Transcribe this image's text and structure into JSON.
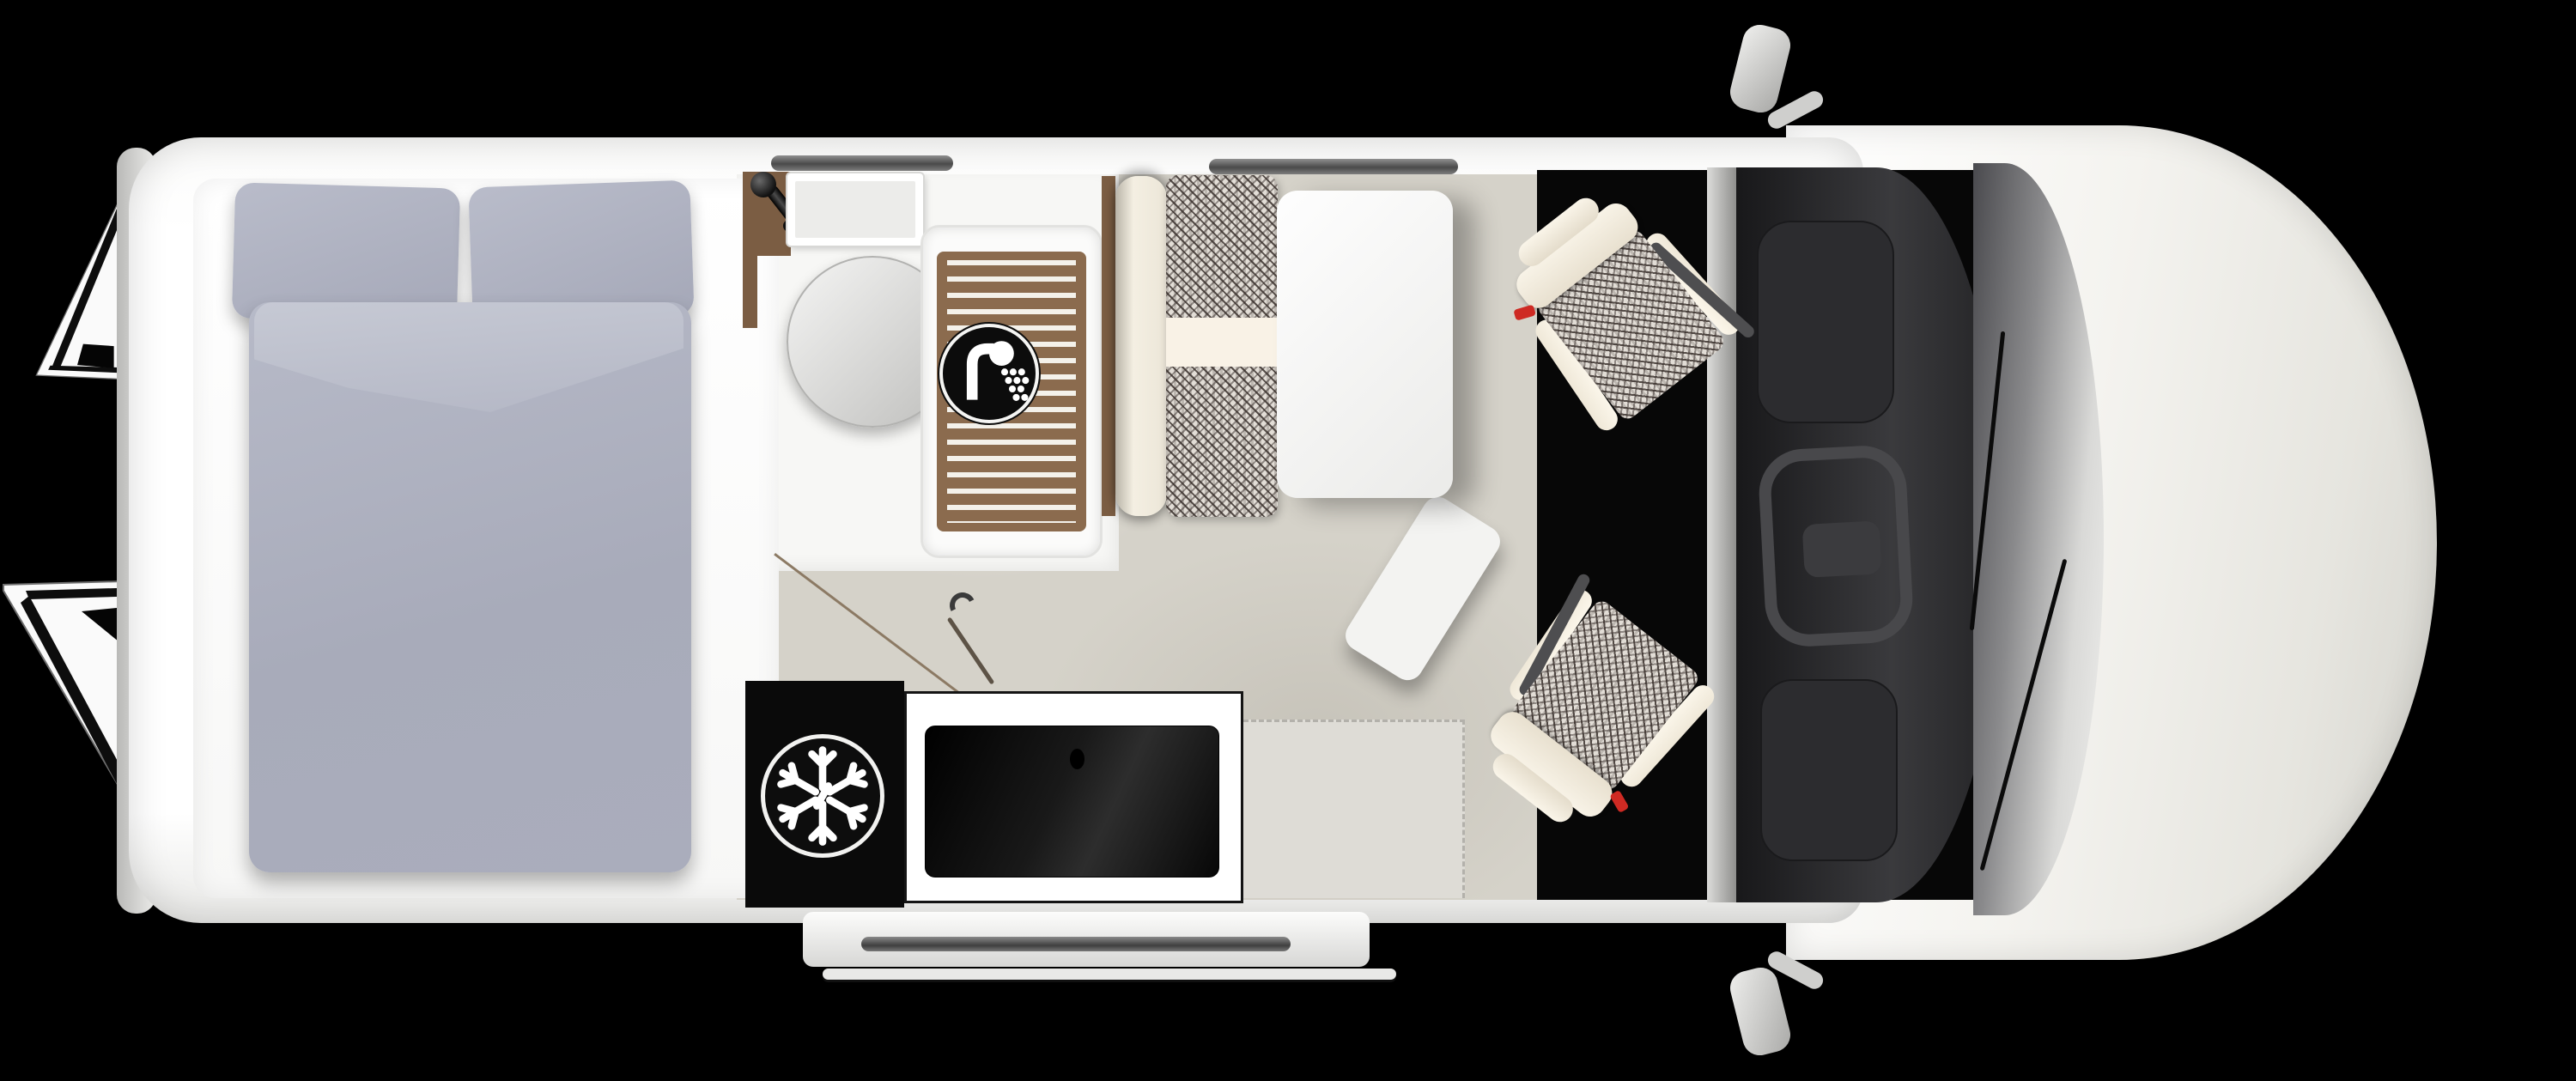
{
  "app": {
    "type": "campervan-floorplan",
    "title": "Campervan top-view floor plan",
    "orientation": {
      "front": "right",
      "rear": "left",
      "view": "top-down"
    },
    "visible_text": "none"
  },
  "vehicle": {
    "rear_doors": {
      "state": "open",
      "count": 2,
      "style": "white panels with black trim lines and window cutouts"
    },
    "mirrors": {
      "count": 2,
      "position": "cab sides"
    },
    "windshield": {
      "wipers": 2,
      "tint": "dark gradient glass"
    },
    "side_step": {
      "position": "bottom sliding-door sill",
      "style": "silver running board with dark rail"
    }
  },
  "areas": {
    "bedroom": {
      "bed": {
        "pillows": 2,
        "duvet": 1,
        "bedding_color": "#aaadbc",
        "platform_color": "#fcfcfb"
      }
    },
    "bathroom": {
      "fixtures": [
        "faucet",
        "sink",
        "round-lid",
        "shower-tray-with-wood-slats"
      ],
      "wood_color": "#7b5d43",
      "badge": {
        "icon": "shower-icon",
        "meaning": "shower / wet bath",
        "style": "white shower glyph in black circle with white ring"
      }
    },
    "kitchen": {
      "fridge": {
        "color": "#0a0a0a",
        "badge": {
          "icon": "snowflake-icon",
          "meaning": "refrigerator / freezer",
          "style": "white snowflake in black circle with white ring"
        }
      },
      "cooktop": {
        "style": "black glass panel on white counter",
        "knobs": 1
      }
    },
    "dinette": {
      "bench": {
        "upholstery": "houndstooth",
        "divider_color": "#f9f2e6",
        "backrest_color": "#f4efe2"
      },
      "table": {
        "color": "#f6f6f4",
        "leaf_extension": true
      }
    },
    "cab": {
      "seats": {
        "count": 2,
        "state": "swiveled toward living area",
        "upholstery": "houndstooth with cream bolsters",
        "belt_accent_color": "#ce2a23"
      },
      "dashboard": {
        "color": "#2c2c2f",
        "steering_wheel": true
      },
      "floor_color": "#070707"
    }
  },
  "colors": {
    "background": "#000000",
    "shell": "#ffffff",
    "floor": "#d5d2c9",
    "bath_floor": "#f7f7f5",
    "bedding": "#aaadbc",
    "wood": "#7b5d43",
    "houndstooth_dark": "#3b322e",
    "houndstooth_light": "#e2ddd6",
    "accent_red": "#ce2a23"
  },
  "icons": [
    {
      "name": "snowflake-icon",
      "meaning": "fridge zone"
    },
    {
      "name": "shower-icon",
      "meaning": "shower zone"
    }
  ]
}
